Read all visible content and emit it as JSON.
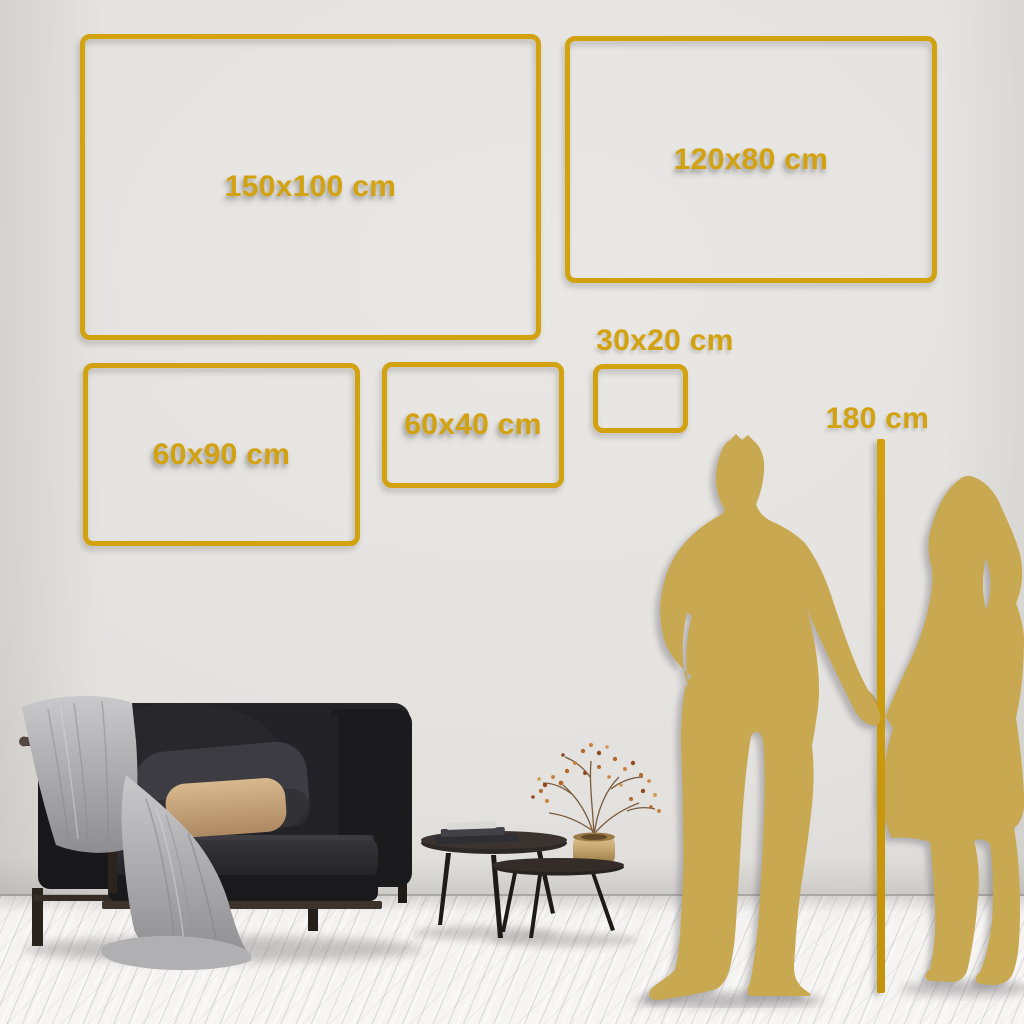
{
  "title": "Wall art size comparison guide",
  "colors": {
    "gold_accent": "#D2A211",
    "silhouette_gold": "#C8A851",
    "wall": "#E4E2DF",
    "floor": "#F5F4F2"
  },
  "size_boxes": [
    {
      "id": "150x100",
      "label": "150x100 cm"
    },
    {
      "id": "120x80",
      "label": "120x80 cm"
    },
    {
      "id": "60x90",
      "label": "60x90 cm"
    },
    {
      "id": "60x40",
      "label": "60x40 cm"
    },
    {
      "id": "30x20",
      "label": "30x20 cm"
    }
  ],
  "height_reference": {
    "label": "180 cm"
  },
  "scene_icons": [
    "sofa-icon",
    "throw-blanket",
    "cushions",
    "coffee-tables-icon",
    "books",
    "brass-vase",
    "dried-branch-plant",
    "man-silhouette-icon",
    "woman-silhouette-icon",
    "height-line"
  ]
}
